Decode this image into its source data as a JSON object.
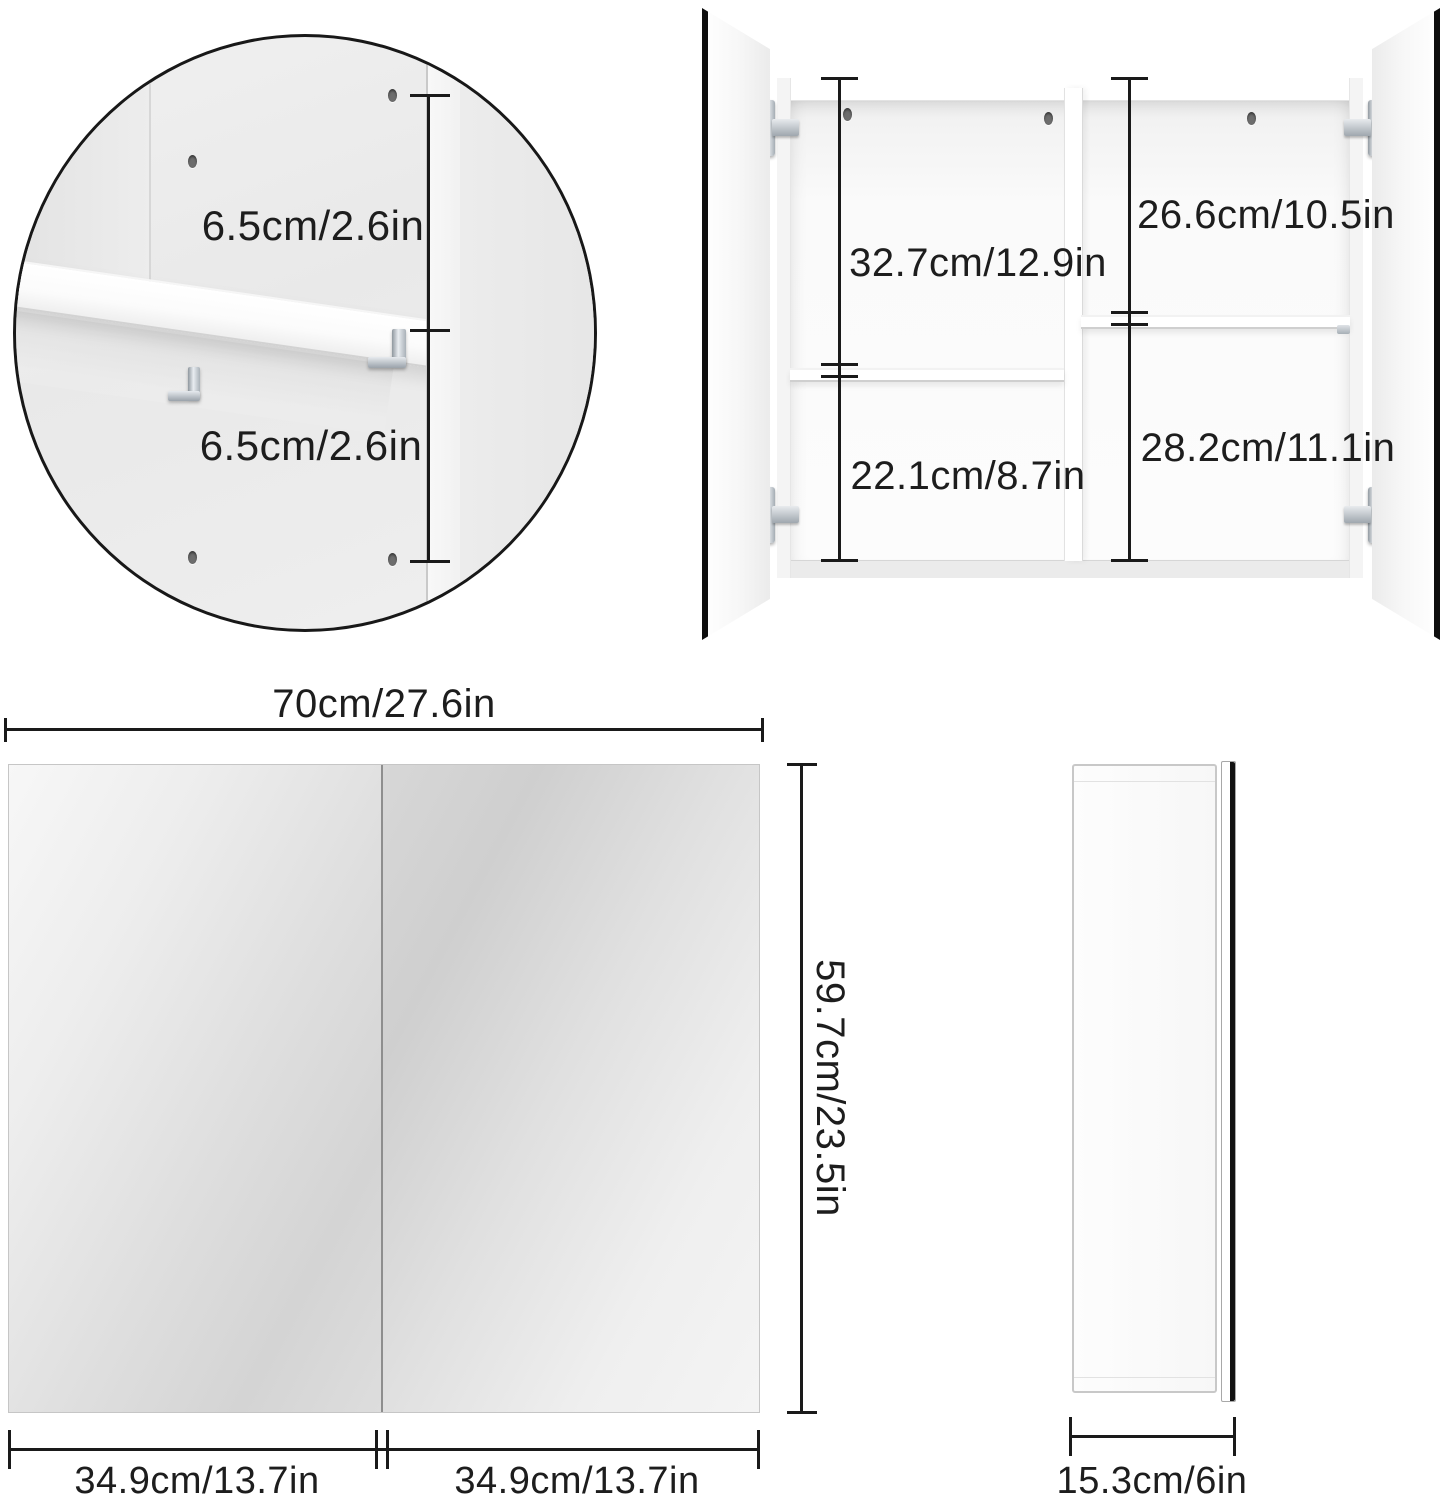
{
  "figure": {
    "type": "product dimension diagram",
    "product": "two-door mirror wall cabinet",
    "colors": {
      "background": "#ffffff",
      "line": "#1a1a1a",
      "text": "#1d1d1d",
      "metal": "#aab2b9",
      "mirror_light": "#f6f6f6",
      "mirror_dark": "#d2d2d2"
    }
  },
  "detail_circle": {
    "upper_gap_label": "6.5cm/2.6in",
    "lower_gap_label": "6.5cm/2.6in"
  },
  "open_cabinet": {
    "left_top_label": "32.7cm/12.9in",
    "left_bottom_label": "22.1cm/8.7in",
    "right_top_label": "26.6cm/10.5in",
    "right_bottom_label": "28.2cm/11.1in"
  },
  "front_view": {
    "width_label": "70cm/27.6in",
    "height_label": "59.7cm/23.5in",
    "left_door_label": "34.9cm/13.7in",
    "right_door_label": "34.9cm/13.7in"
  },
  "side_view": {
    "depth_label": "15.3cm/6in"
  }
}
